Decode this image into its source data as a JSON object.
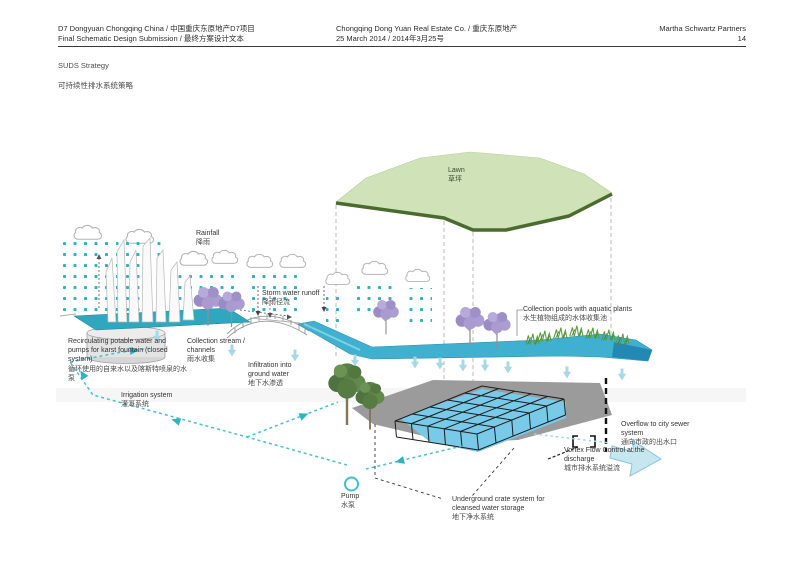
{
  "header": {
    "left": {
      "line1": "D7 Dongyuan Chongqing China / 中国重庆东原地产D7项目",
      "line2": "Final Schematic Design Submission / 最终方案设计文本"
    },
    "center": {
      "line1": "Chongqing Dong Yuan Real Estate Co. / 重庆东原地产",
      "line2": "25 March 2014 / 2014年3月25号"
    },
    "right": {
      "company": "Martha Schwartz Partners",
      "page_number": "14"
    }
  },
  "title": {
    "en": "SUDS Strategy",
    "zh": "可持续性排水系统策略"
  },
  "diagram": {
    "labels": {
      "lawn": {
        "en": "Lawn",
        "zh": "草坪"
      },
      "rainfall": {
        "en": "Rainfall",
        "zh": "降雨"
      },
      "storm_runoff": {
        "en": "Storm water runoff",
        "zh": "降雨径流"
      },
      "recirculating": {
        "en": "Recirculating potable water and pumps for karst fountain (closed system)",
        "zh": "循环使用的自来水以及喀斯特喷泉的水泵"
      },
      "collection_stream": {
        "en": "Collection stream / channels",
        "zh": "雨水收集"
      },
      "infiltration": {
        "en": "Infiltration into ground water",
        "zh": "地下水渗透"
      },
      "irrigation": {
        "en": "Irrigation system",
        "zh": "灌溉系统"
      },
      "collection_pools": {
        "en": "Collection pools with aquatic plants",
        "zh": "水生植物组成的水体收集池"
      },
      "overflow": {
        "en": "Overflow to city sewer system",
        "zh": "通向市政的出水口"
      },
      "vortex": {
        "en": "Vortex Flow Control at the discharge",
        "zh": "城市排水系统溢流"
      },
      "underground": {
        "en": "Underground crate system for cleansed water storage",
        "zh": "地下净水系统"
      },
      "pump": {
        "en": "Pump",
        "zh": "水泵"
      }
    },
    "colors": {
      "rain_teal": "#2eb3c1",
      "channel_blue": "#3fb0cf",
      "crate_water_blue": "#79c9e8",
      "lawn_green": "#cfe2b8",
      "lawn_edge_green": "#4b6b2e",
      "tree_purple": "#a495cd",
      "tree_green": "#5a8046",
      "platform_gray": "#9b9b9b",
      "irrigation_teal": "#46c0cc",
      "light_arrow_blue": "#a6d9e8"
    }
  }
}
